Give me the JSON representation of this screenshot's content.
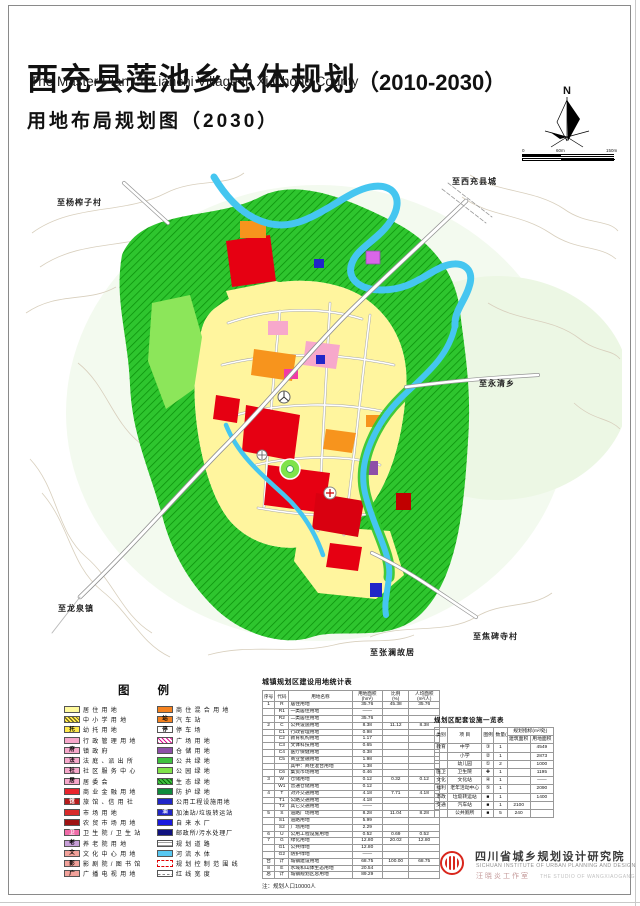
{
  "page": {
    "title_cn": "西充县莲池乡总体规划",
    "title_paren": "（2010-2030）",
    "title_en": "The Master Plan Of Lianchi Village In Xi Chong County",
    "subtitle": "用地布局规划图（2030）"
  },
  "north": {
    "n": "N",
    "scale": [
      "0",
      "60m",
      "150m"
    ]
  },
  "map": {
    "labels": [
      {
        "text": "至西充县城",
        "x": 452,
        "y": 176
      },
      {
        "text": "至杨榨子村",
        "x": 57,
        "y": 197
      },
      {
        "text": "至永清乡",
        "x": 479,
        "y": 378
      },
      {
        "text": "至龙泉镇",
        "x": 58,
        "y": 603
      },
      {
        "text": "至焦碑寺村",
        "x": 473,
        "y": 631
      },
      {
        "text": "至张澜故居",
        "x": 370,
        "y": 647
      }
    ]
  },
  "legend": {
    "title": "图例",
    "left": [
      {
        "label": "居 住 用 地",
        "bg": "#FFFA9C"
      },
      {
        "label": "中 小 学 用 地",
        "bg": "#FFE94D",
        "pattern": "hatchBlack"
      },
      {
        "label": "幼 托 用 地",
        "bg": "#FFE94D",
        "glyph": "托",
        "fg": "#000"
      },
      {
        "label": "行 政 管 理 用 地",
        "bg": "#F7A8CB"
      },
      {
        "label": "镇 政 府",
        "bg": "#F7A8CB",
        "glyph": "府",
        "fg": "#000"
      },
      {
        "label": "法 庭 、派 出 所",
        "bg": "#F7A8CB",
        "glyph": "法",
        "fg": "#000"
      },
      {
        "label": "社 区 服 务 中 心",
        "bg": "#F7A8CB",
        "glyph": "社",
        "fg": "#000"
      },
      {
        "label": "居 委 会",
        "bg": "#F7A8CB",
        "glyph": "居",
        "fg": "#000"
      },
      {
        "label": "商 业 金 融 用 地",
        "bg": "#E8252D"
      },
      {
        "label": "旅 馆 、信 用 社",
        "bg": "#B71C1C",
        "glyph": "馆",
        "fg": "#fff"
      },
      {
        "label": "市 场 用 地",
        "bg": "#D82A2A"
      },
      {
        "label": "农 贸 市 场 用 地",
        "bg": "#9E1212"
      },
      {
        "label": "卫 生 院 / 卫 生 站",
        "bg": "#F06CA8",
        "glyph": "卫",
        "fg": "#fff"
      },
      {
        "label": "养 老 院 用 地",
        "bg": "#C79FD8",
        "glyph": "老",
        "fg": "#000"
      },
      {
        "label": "文 化 中 心 用 地",
        "bg": "#F2A29B",
        "glyph": "文",
        "fg": "#000"
      },
      {
        "label": "影 剧 院 / 图 书 馆",
        "bg": "#F2A29B",
        "glyph": "影",
        "fg": "#000"
      },
      {
        "label": "广 播 电 视 用 地",
        "bg": "#F2A29B",
        "glyph": "广",
        "fg": "#000"
      }
    ],
    "right": [
      {
        "label": "商 住 混 合 用 地",
        "bg": "#F58220"
      },
      {
        "label": "汽 车 站",
        "bg": "#F58220",
        "glyph": "站",
        "fg": "#000"
      },
      {
        "label": "停 车 场",
        "bg": "#FFFFFF",
        "glyph": "停",
        "fg": "#000"
      },
      {
        "label": "广 场 用 地",
        "bg": "#FFFFFF",
        "pattern": "hatchMagenta"
      },
      {
        "label": "仓 储 用 地",
        "bg": "#8E4FA8"
      },
      {
        "label": "公 共 绿 地",
        "bg": "#3FC13F"
      },
      {
        "label": "公 园 绿 地",
        "bg": "#7FE34A"
      },
      {
        "label": "生 态 绿 地",
        "bg": "#3FC13F",
        "pattern": "hatchGreen"
      },
      {
        "label": "防 护 绿 地",
        "bg": "#0F8B3C"
      },
      {
        "label": "公用工程设施用地",
        "bg": "#2026C8"
      },
      {
        "label": "加油站/垃圾转运站",
        "bg": "#2026C8",
        "glyph": "油",
        "fg": "#fff"
      },
      {
        "label": "自 来 水 厂",
        "bg": "#1A1ADF"
      },
      {
        "label": "邮政所/污水处理厂",
        "bg": "#10127F"
      },
      {
        "label": "规 划 道 路",
        "bg": "#FFFFFF",
        "pattern": "road"
      },
      {
        "label": "河 流 水 体",
        "bg": "#57C8F2"
      },
      {
        "label": "规 划 控 制 范 围 线",
        "bg": "#FFFFFF",
        "pattern": "dashRed"
      },
      {
        "label": "红 线 宽 度",
        "bg": "#FFFFFF",
        "pattern": "dashes"
      }
    ]
  },
  "land_use_table": {
    "title": "城镇规划区建设用地统计表",
    "headers": [
      "序号",
      "代码",
      "用地名称",
      "用地面积\n(hm²)",
      "比例\n(%)",
      "人均面积\n(m²/人)"
    ],
    "rows": [
      [
        "1",
        "R",
        "居住用地",
        "35.76",
        "45.38",
        "35.76"
      ],
      [
        "",
        "R1",
        "一类居住用地",
        "——",
        "",
        ""
      ],
      [
        "",
        "R2",
        "二类居住用地",
        "35.76",
        "",
        ""
      ],
      [
        "2",
        "C",
        "公共设施用地",
        "8.38",
        "11.12",
        "8.38"
      ],
      [
        "",
        "C1",
        "行政管理用地",
        "0.98",
        "",
        ""
      ],
      [
        "",
        "C2",
        "教育机构用地",
        "1.17",
        "",
        ""
      ],
      [
        "",
        "C3",
        "文体科技用地",
        "0.65",
        "",
        ""
      ],
      [
        "",
        "C4",
        "医疗保健用地",
        "0.38",
        "",
        ""
      ],
      [
        "",
        "C5",
        "商业金融用地",
        "1.98",
        "",
        ""
      ],
      [
        "",
        "",
        "其中：商住混合用地",
        "1.38",
        "",
        ""
      ],
      [
        "",
        "C6",
        "集贸市场用地",
        "0.46",
        "",
        ""
      ],
      [
        "3",
        "W",
        "仓储用地",
        "0.12",
        "0.32",
        "0.12"
      ],
      [
        "",
        "W1",
        "普通仓储用地",
        "0.12",
        "",
        ""
      ],
      [
        "4",
        "T",
        "对外交通用地",
        "4.18",
        "7.71",
        "4.18"
      ],
      [
        "",
        "T1",
        "公路交通用地",
        "4.18",
        "",
        ""
      ],
      [
        "",
        "T2",
        "其它交通用地",
        "——",
        "",
        ""
      ],
      [
        "5",
        "S",
        "道路广场用地",
        "8.28",
        "11.04",
        "8.28"
      ],
      [
        "",
        "S1",
        "道路用地",
        "5.99",
        "",
        ""
      ],
      [
        "",
        "S2",
        "广场用地",
        "2.29",
        "",
        ""
      ],
      [
        "6",
        "U",
        "公用工程设施用地",
        "0.52",
        "0.69",
        "0.52"
      ],
      [
        "7",
        "G",
        "绿化用地",
        "12.80",
        "20.02",
        "12.80"
      ],
      [
        "",
        "G1",
        "公共绿地",
        "12.80",
        "",
        ""
      ],
      [
        "",
        "G2",
        "防护绿地",
        "——",
        "",
        ""
      ],
      [
        "合",
        "计",
        "城镇建设用地",
        "68.75",
        "100.00",
        "68.75"
      ],
      [
        "8",
        "E",
        "水域和山体生态用地",
        "20.54",
        "",
        ""
      ],
      [
        "总",
        "计",
        "城镇规划区总用地",
        "89.29",
        "",
        ""
      ]
    ],
    "note": "注：规划人口10000人"
  },
  "facilities_table": {
    "title": "规划区配套设施一览表",
    "h": {
      "cat": "类别",
      "item": "项 目",
      "sym": "图例",
      "qty": "数量(处)",
      "group": "规划指标(m²/处)",
      "jz": "建筑面积",
      "yd": "用地面积"
    },
    "rows": [
      [
        "教育",
        "中学",
        "③",
        "1",
        "",
        "4549"
      ],
      [
        "",
        "小学",
        "②",
        "1",
        "",
        "2873"
      ],
      [
        "",
        "幼儿园",
        "①",
        "2",
        "",
        "1000"
      ],
      [
        "医卫",
        "卫生院",
        "✚",
        "1",
        "",
        "1195"
      ],
      [
        "文化",
        "文化站",
        "④",
        "1",
        "",
        "——"
      ],
      [
        "福利",
        "老年活动中心",
        "⑤",
        "1",
        "",
        "2090"
      ],
      [
        "市政",
        "垃圾转运站",
        "■",
        "1",
        "",
        "1400"
      ],
      [
        "交通",
        "汽车站",
        "■",
        "1",
        "2100",
        ""
      ],
      [
        "",
        "公共厕所",
        "■",
        "5",
        "240",
        ""
      ]
    ]
  },
  "publisher": {
    "cn": "四川省城乡规划设计研究院",
    "en": "SICHUAN INSTITUTE OF URBAN PLANNING AND DESIGN",
    "studio_cn": "汪晓炎工作室",
    "studio_en": "THE STUDIO OF WANGXIAOGANG"
  },
  "colors": {
    "residential_yellow": "#FFFA9C",
    "commercial_red": "#E8252D",
    "mixed_orange": "#F58220",
    "admin_pink": "#F7A8CB",
    "eco_green": "#3FC13F",
    "park_green": "#7FE34A",
    "protect_green": "#0F8B3C",
    "warehouse_purple": "#8E4FA8",
    "utility_blue": "#2026C8",
    "water_cyan": "#57C8F2",
    "brand_red": "#D9261C"
  }
}
